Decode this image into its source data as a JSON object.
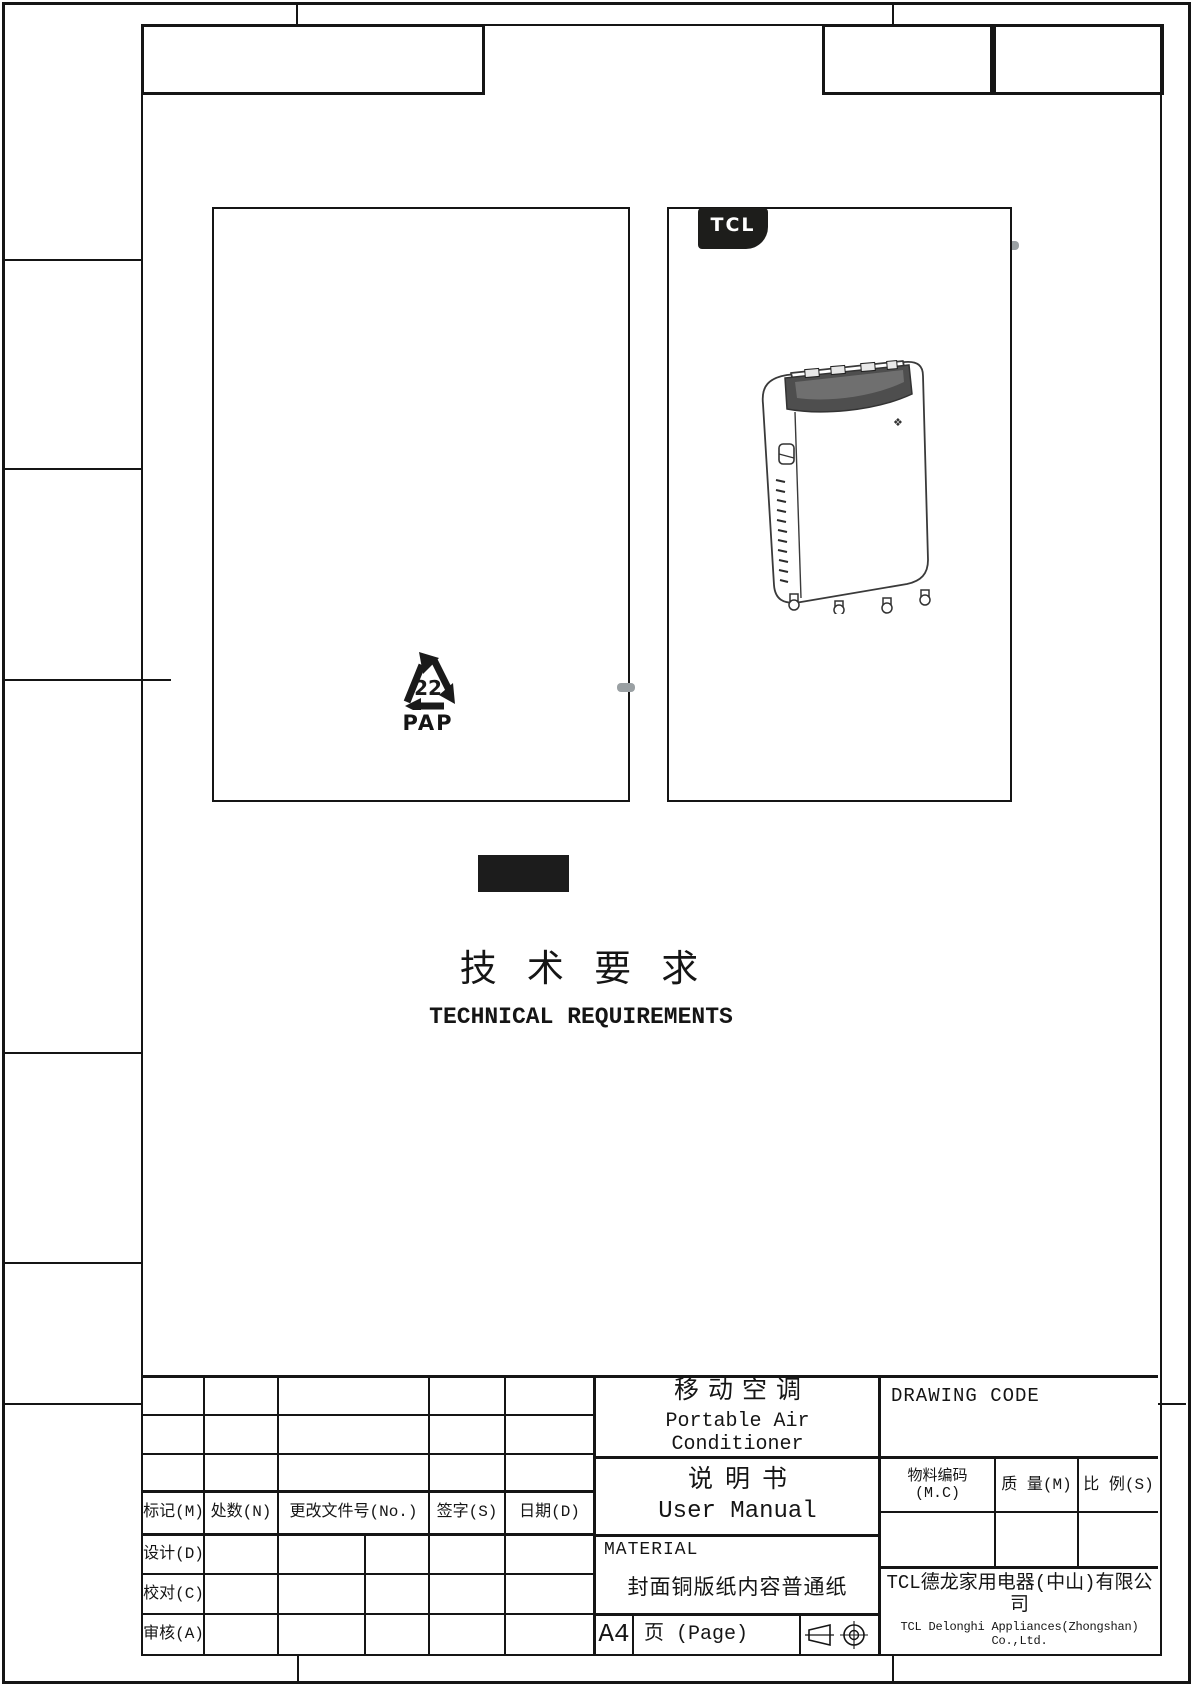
{
  "page": {
    "section_title_cn": "技 术 要 求",
    "section_title_en": "TECHNICAL REQUIREMENTS"
  },
  "cover": {
    "brand": "TCL",
    "recycle_code": "22",
    "recycle_material": "PAP"
  },
  "titleblock": {
    "product_cn": "移动空调",
    "product_en": "Portable Air Conditioner",
    "doc_cn": "说明书",
    "doc_en": "User Manual",
    "drawing_code_label": "DRAWING CODE",
    "material_label": "MATERIAL",
    "material_value": "封面铜版纸内容普通纸",
    "paper_size": "A4",
    "page_label": "页 (Page)",
    "mc_label": "物料编码 (M.C)",
    "mass_label": "质 量(M)",
    "scale_label": "比 例(S)",
    "company_cn": "TCL德龙家用电器(中山)有限公司",
    "company_en": "TCL Delonghi Appliances(Zhongshan) Co.,Ltd.",
    "revision": {
      "headers": [
        "标记(M)",
        "处数(N)",
        "更改文件号(No.)",
        "签字(S)",
        "日期(D)"
      ],
      "sign_rows": [
        "设计(D)",
        "校对(C)",
        "审核(A)"
      ]
    }
  },
  "colors": {
    "line": "#151515",
    "redaction_black": "#1c1c1c",
    "tab_gray": "#9aa0a3",
    "logo_black": "#1d1d1b"
  }
}
